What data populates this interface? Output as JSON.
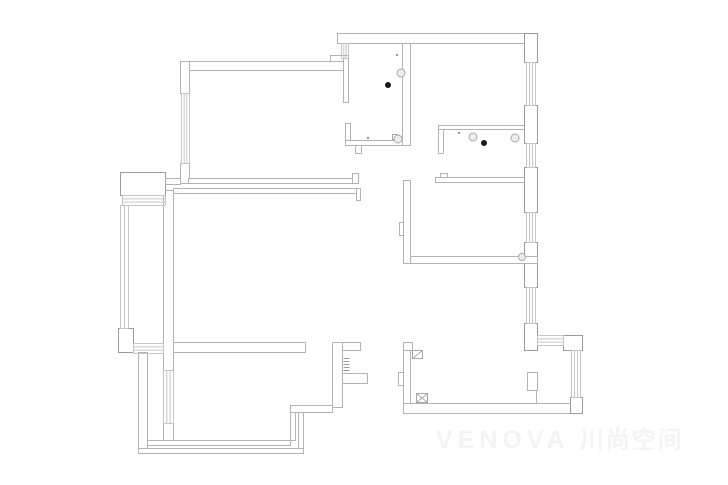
{
  "page": {
    "background": "#ffffff"
  },
  "watermark": {
    "text_latin": "VENOVA",
    "text_cjk": "川尚空间",
    "color": "#f4f4f4"
  },
  "plan": {
    "stroke": "#b3b3b3",
    "stroke_dark": "#9b9b9b",
    "window_stroke": "#c6c6c6",
    "fixture_stroke": "#a8a8a8",
    "fixture_fill": "#ededed",
    "black_dot_color": "#1a1a1a",
    "tiny_dot_color": "#9a9a9a",
    "walls": [
      {
        "x": 337,
        "y": 33,
        "w": 200,
        "h": 10
      },
      {
        "x": 180,
        "y": 61,
        "w": 167,
        "h": 9
      },
      {
        "x": 180,
        "y": 61,
        "w": 9,
        "h": 32
      },
      {
        "x": 180,
        "y": 163,
        "w": 9,
        "h": 20
      },
      {
        "x": 188,
        "y": 178,
        "w": 164,
        "h": 5
      },
      {
        "x": 352,
        "y": 173,
        "w": 6,
        "h": 10
      },
      {
        "x": 330,
        "y": 55,
        "w": 18,
        "h": 6
      },
      {
        "x": 343,
        "y": 58,
        "w": 5,
        "h": 44
      },
      {
        "x": 345,
        "y": 123,
        "w": 5,
        "h": 17
      },
      {
        "x": 345,
        "y": 140,
        "w": 65,
        "h": 5
      },
      {
        "x": 355,
        "y": 145,
        "w": 6,
        "h": 8
      },
      {
        "x": 402,
        "y": 43,
        "w": 8,
        "h": 102
      },
      {
        "x": 438,
        "y": 125,
        "w": 88,
        "h": 4
      },
      {
        "x": 438,
        "y": 129,
        "w": 5,
        "h": 24
      },
      {
        "x": 435,
        "y": 177,
        "w": 92,
        "h": 5
      },
      {
        "x": 440,
        "y": 173,
        "w": 7,
        "h": 4
      },
      {
        "x": 524,
        "y": 33,
        "w": 13,
        "h": 29,
        "dark": true
      },
      {
        "x": 524,
        "y": 105,
        "w": 13,
        "h": 38,
        "dark": true
      },
      {
        "x": 524,
        "y": 167,
        "w": 13,
        "h": 45,
        "dark": true
      },
      {
        "x": 524,
        "y": 242,
        "w": 13,
        "h": 45,
        "dark": true
      },
      {
        "x": 524,
        "y": 323,
        "w": 13,
        "h": 27,
        "dark": true
      },
      {
        "x": 403,
        "y": 180,
        "w": 7,
        "h": 83
      },
      {
        "x": 399,
        "y": 222,
        "w": 4,
        "h": 13
      },
      {
        "x": 410,
        "y": 256,
        "w": 127,
        "h": 7
      },
      {
        "x": 173,
        "y": 188,
        "w": 187,
        "h": 5
      },
      {
        "x": 356,
        "y": 188,
        "w": 4,
        "h": 12
      },
      {
        "x": 163,
        "y": 190,
        "w": 10,
        "h": 180
      },
      {
        "x": 163,
        "y": 423,
        "w": 10,
        "h": 19
      },
      {
        "x": 120,
        "y": 172,
        "w": 45,
        "h": 23,
        "dark": true
      },
      {
        "x": 165,
        "y": 178,
        "w": 15,
        "h": 6
      },
      {
        "x": 118,
        "y": 328,
        "w": 15,
        "h": 24,
        "dark": true
      },
      {
        "x": 173,
        "y": 342,
        "w": 132,
        "h": 10
      },
      {
        "x": 138,
        "y": 352,
        "w": 9,
        "h": 101
      },
      {
        "x": 138,
        "y": 448,
        "w": 165,
        "h": 5
      },
      {
        "x": 147,
        "y": 440,
        "w": 143,
        "h": 5
      },
      {
        "x": 290,
        "y": 410,
        "w": 5,
        "h": 30
      },
      {
        "x": 298,
        "y": 412,
        "w": 5,
        "h": 36
      },
      {
        "x": 290,
        "y": 405,
        "w": 42,
        "h": 7
      },
      {
        "x": 332,
        "y": 342,
        "w": 10,
        "h": 65
      },
      {
        "x": 342,
        "y": 342,
        "w": 18,
        "h": 8
      },
      {
        "x": 342,
        "y": 373,
        "w": 25,
        "h": 10
      },
      {
        "x": 403,
        "y": 342,
        "w": 9,
        "h": 8
      },
      {
        "x": 403,
        "y": 350,
        "w": 7,
        "h": 63
      },
      {
        "x": 398,
        "y": 372,
        "w": 5,
        "h": 13
      },
      {
        "x": 403,
        "y": 403,
        "w": 179,
        "h": 10
      },
      {
        "x": 527,
        "y": 372,
        "w": 10,
        "h": 18
      },
      {
        "x": 563,
        "y": 335,
        "w": 19,
        "h": 15,
        "dark": true
      },
      {
        "x": 570,
        "y": 397,
        "w": 12,
        "h": 16,
        "dark": true
      }
    ],
    "windows": [
      {
        "x": 341,
        "y": 43,
        "w": 7,
        "h": 15,
        "o": "v",
        "n": 4
      },
      {
        "x": 181,
        "y": 93,
        "w": 8,
        "h": 70,
        "o": "v",
        "n": 4
      },
      {
        "x": 526,
        "y": 62,
        "w": 9,
        "h": 43,
        "o": "v",
        "n": 4
      },
      {
        "x": 526,
        "y": 143,
        "w": 9,
        "h": 24,
        "o": "v",
        "n": 4
      },
      {
        "x": 526,
        "y": 212,
        "w": 9,
        "h": 30,
        "o": "v",
        "n": 4
      },
      {
        "x": 526,
        "y": 287,
        "w": 9,
        "h": 36,
        "o": "v",
        "n": 4
      },
      {
        "x": 122,
        "y": 195,
        "w": 43,
        "h": 10,
        "o": "h",
        "n": 4
      },
      {
        "x": 120,
        "y": 205,
        "w": 8,
        "h": 123,
        "o": "v",
        "n": 3
      },
      {
        "x": 133,
        "y": 343,
        "w": 30,
        "h": 10,
        "o": "h",
        "n": 4
      },
      {
        "x": 163,
        "y": 370,
        "w": 10,
        "h": 53,
        "o": "v",
        "n": 4
      },
      {
        "x": 537,
        "y": 335,
        "w": 26,
        "h": 10,
        "o": "h",
        "n": 4
      },
      {
        "x": 571,
        "y": 350,
        "w": 9,
        "h": 47,
        "o": "v",
        "n": 4
      }
    ],
    "lines": [
      {
        "x1": 536,
        "y1": 390,
        "x2": 536,
        "y2": 403
      }
    ],
    "hatches": [
      {
        "x": 343,
        "y": 358,
        "w": 6,
        "h": 14
      }
    ],
    "symbols": {
      "box_plain": [
        {
          "x": 412,
          "y": 350,
          "w": 10,
          "h": 8
        }
      ],
      "box_x": [
        {
          "x": 416,
          "y": 393,
          "w": 11,
          "h": 9
        }
      ],
      "squares": [
        {
          "x": 392,
          "y": 134,
          "w": 5,
          "h": 5
        }
      ]
    },
    "fixtures": {
      "circles": [
        {
          "cx": 401,
          "cy": 73,
          "r": 4
        },
        {
          "cx": 398,
          "cy": 139,
          "r": 4
        },
        {
          "cx": 473,
          "cy": 137,
          "r": 4
        },
        {
          "cx": 515,
          "cy": 138,
          "r": 4
        },
        {
          "cx": 522,
          "cy": 257,
          "r": 3.5
        }
      ],
      "black_dots": [
        {
          "cx": 388,
          "cy": 85,
          "r": 3
        },
        {
          "cx": 484,
          "cy": 143,
          "r": 3
        }
      ],
      "tiny_dots": [
        {
          "cx": 397,
          "cy": 55,
          "r": 1.2
        },
        {
          "cx": 368,
          "cy": 138,
          "r": 1.2
        },
        {
          "cx": 459,
          "cy": 133,
          "r": 1.2
        }
      ]
    }
  }
}
